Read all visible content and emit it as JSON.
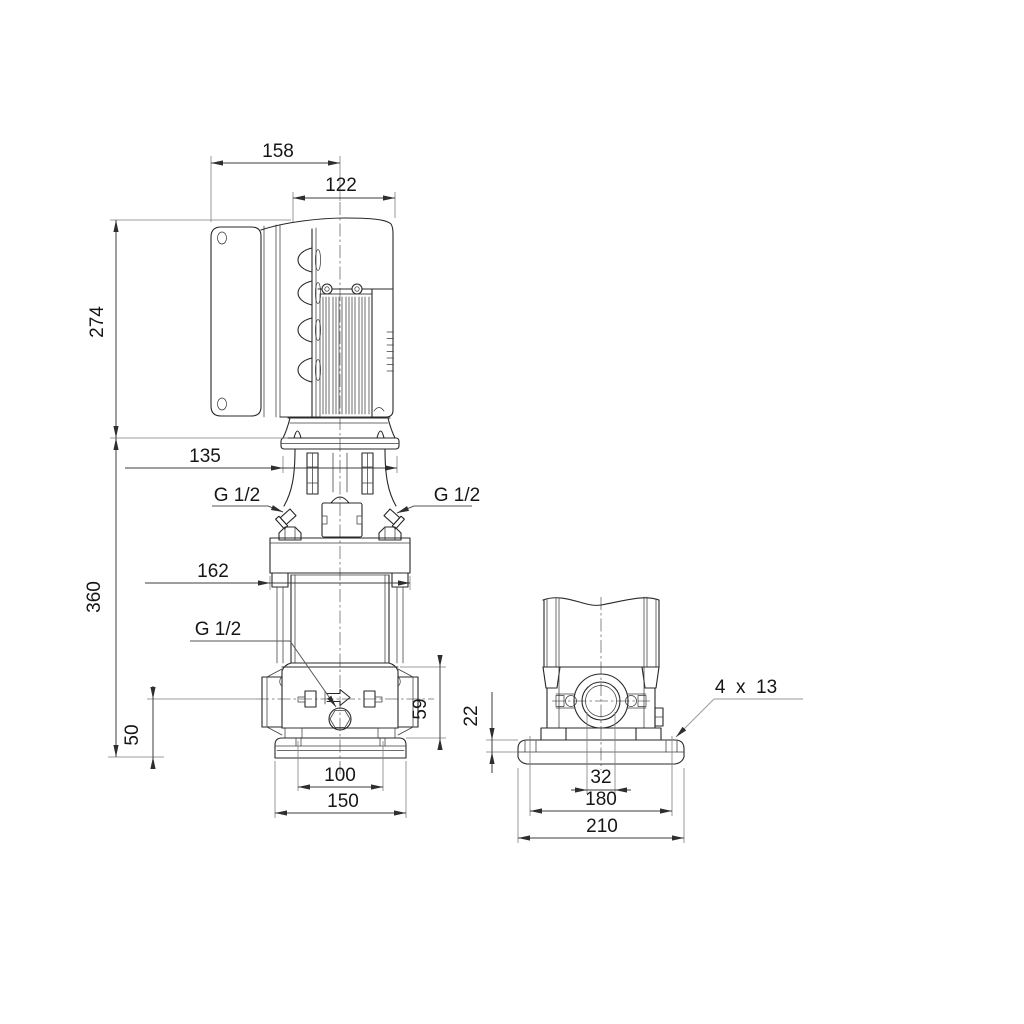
{
  "drawing": {
    "dims": {
      "d158": "158",
      "d122": "122",
      "d274": "274",
      "d135": "135",
      "d162": "162",
      "d360": "360",
      "d50": "50",
      "d59": "59",
      "d100": "100",
      "d150": "150",
      "d22": "22",
      "d32": "32",
      "d180": "180",
      "d210": "210"
    },
    "labels": {
      "g12_top_left": "G 1/2",
      "g12_top_right": "G 1/2",
      "g12_drain": "G 1/2",
      "holes": "4  x  13"
    }
  }
}
